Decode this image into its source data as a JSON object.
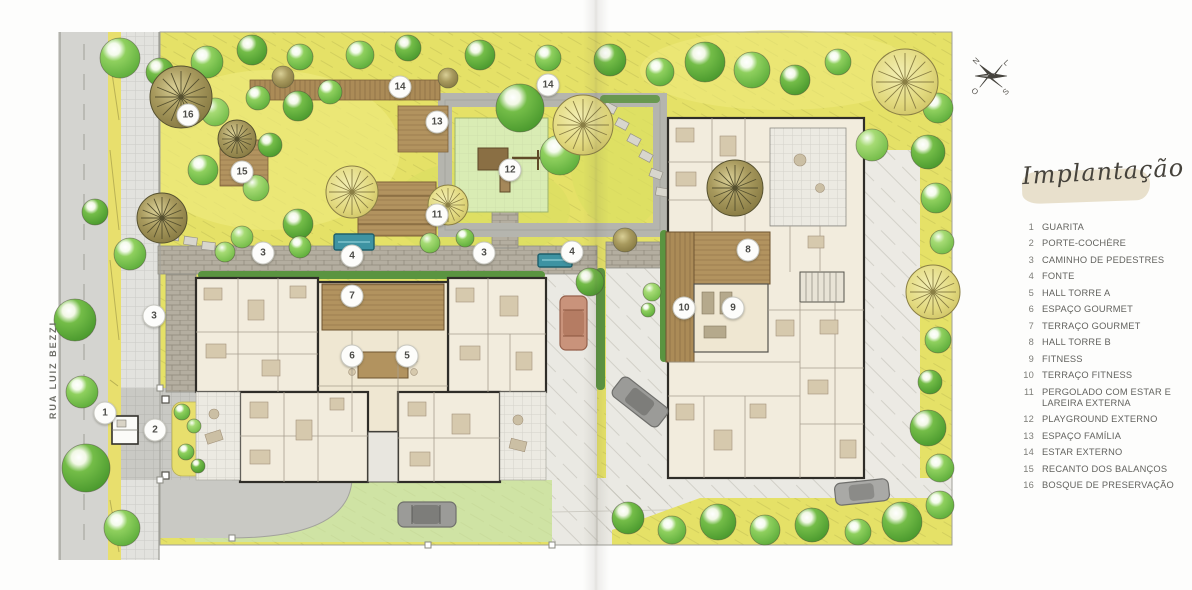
{
  "legend": {
    "title": "Implantação",
    "items": [
      {
        "num": "1",
        "label": "GUARITA"
      },
      {
        "num": "2",
        "label": "PORTE-COCHÈRE"
      },
      {
        "num": "3",
        "label": "CAMINHO DE PEDESTRES"
      },
      {
        "num": "4",
        "label": "FONTE"
      },
      {
        "num": "5",
        "label": "HALL TORRE A"
      },
      {
        "num": "6",
        "label": "ESPAÇO GOURMET"
      },
      {
        "num": "7",
        "label": "TERRAÇO GOURMET"
      },
      {
        "num": "8",
        "label": "HALL TORRE B"
      },
      {
        "num": "9",
        "label": "FITNESS"
      },
      {
        "num": "10",
        "label": "TERRAÇO FITNESS"
      },
      {
        "num": "11",
        "label": "PERGOLADO COM ESTAR E LAREIRA EXTERNA"
      },
      {
        "num": "12",
        "label": "PLAYGROUND EXTERNO"
      },
      {
        "num": "13",
        "label": "ESPAÇO FAMÍLIA"
      },
      {
        "num": "14",
        "label": "ESTAR EXTERNO"
      },
      {
        "num": "15",
        "label": "RECANTO DOS BALANÇOS"
      },
      {
        "num": "16",
        "label": "BOSQUE DE PRESERVAÇÃO"
      }
    ]
  },
  "map": {
    "street_label": "RUA LUIZ BEZZI",
    "markers": [
      {
        "n": "1",
        "x": 105,
        "y": 413
      },
      {
        "n": "2",
        "x": 155,
        "y": 430
      },
      {
        "n": "3",
        "x": 154,
        "y": 316
      },
      {
        "n": "3",
        "x": 263,
        "y": 253
      },
      {
        "n": "3",
        "x": 484,
        "y": 253
      },
      {
        "n": "4",
        "x": 352,
        "y": 256
      },
      {
        "n": "4",
        "x": 572,
        "y": 252
      },
      {
        "n": "5",
        "x": 407,
        "y": 356
      },
      {
        "n": "6",
        "x": 352,
        "y": 356
      },
      {
        "n": "7",
        "x": 352,
        "y": 296
      },
      {
        "n": "8",
        "x": 748,
        "y": 250
      },
      {
        "n": "9",
        "x": 733,
        "y": 308
      },
      {
        "n": "10",
        "x": 684,
        "y": 308
      },
      {
        "n": "11",
        "x": 437,
        "y": 215
      },
      {
        "n": "12",
        "x": 510,
        "y": 170
      },
      {
        "n": "13",
        "x": 437,
        "y": 122
      },
      {
        "n": "14",
        "x": 400,
        "y": 87
      },
      {
        "n": "14",
        "x": 548,
        "y": 85
      },
      {
        "n": "15",
        "x": 242,
        "y": 172
      },
      {
        "n": "16",
        "x": 188,
        "y": 115
      }
    ]
  },
  "compass": {
    "north": "N",
    "east": "L",
    "south": "S",
    "west": "O"
  },
  "colors": {
    "lawn_yellow": "#e5e167",
    "lawn_green": "#cfe3a4",
    "tree_green": "#5fae3c",
    "tree_olive": "#8d8148",
    "path_gray": "#b6b6ae",
    "building_fill": "#f2ecdd",
    "building_outline": "#2f2d28",
    "wood_deck": "#b2935f",
    "water": "#3e93a2",
    "brush_stroke": "#e4dac3",
    "legend_text": "#63635f"
  }
}
